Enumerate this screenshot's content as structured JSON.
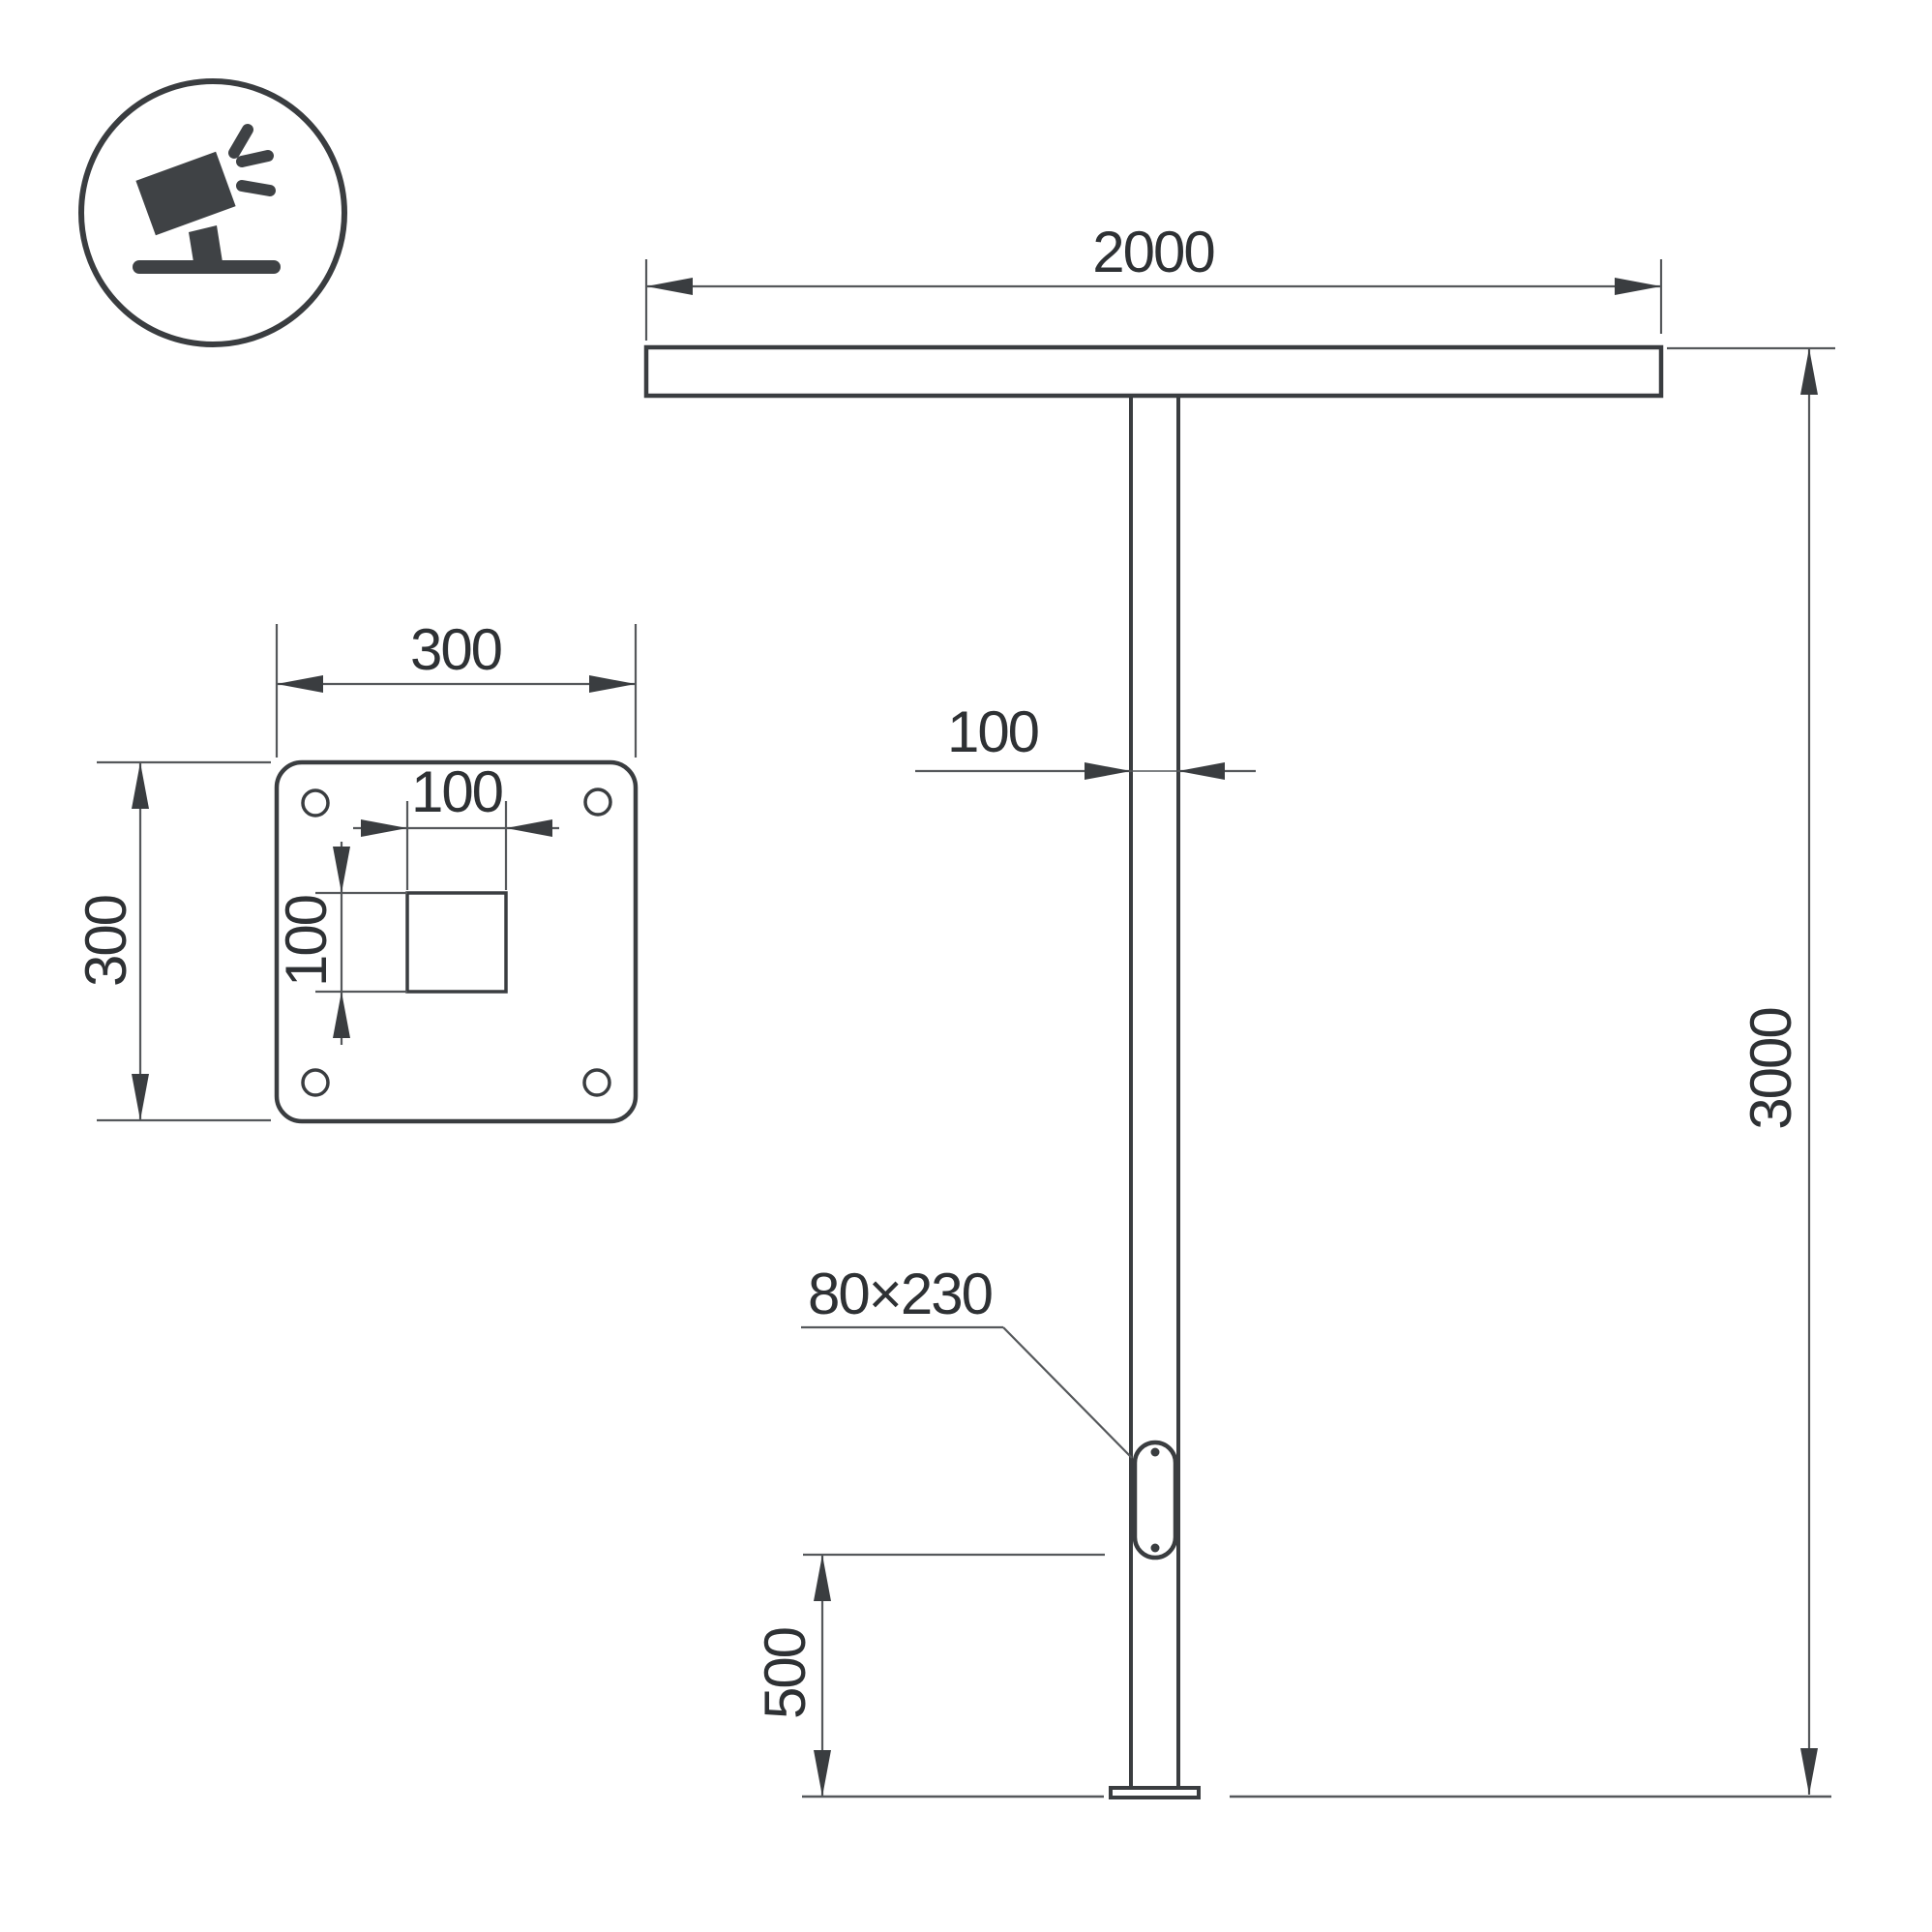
{
  "diagram": {
    "type": "technical-drawing",
    "front_view": {
      "crossbar_width": "2000",
      "pole_height": "3000",
      "pole_width": "100",
      "service_door_size": "80×230",
      "door_bottom_height": "500"
    },
    "base_plate_view": {
      "plate_width": "300",
      "plate_height": "300",
      "center_hole_width": "100",
      "center_hole_height": "100"
    },
    "colors": {
      "object_line": "#3a3d40",
      "dimension_line": "#55585b",
      "text": "#2e3134",
      "background": "#ffffff"
    }
  }
}
